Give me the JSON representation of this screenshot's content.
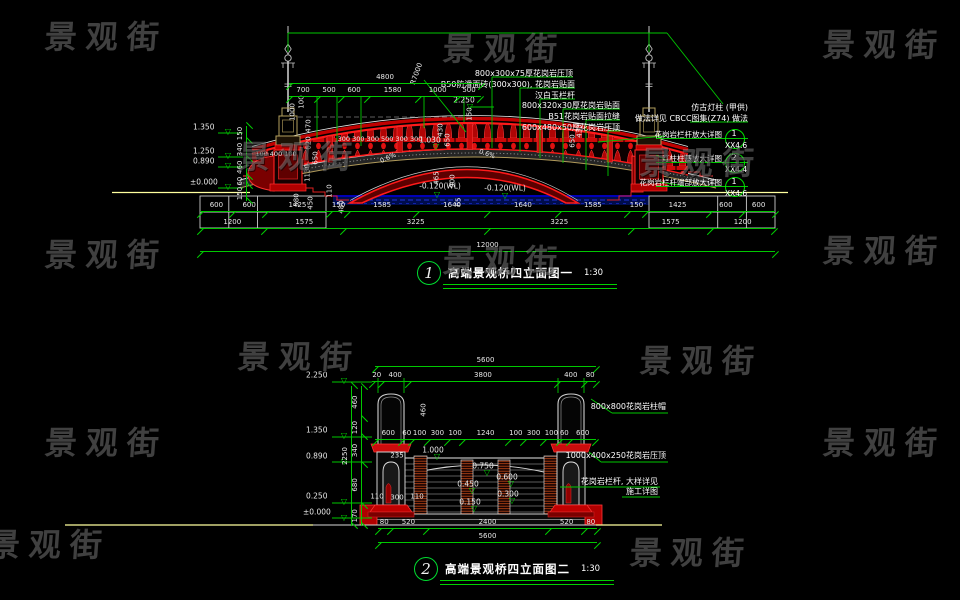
{
  "meta": {
    "background": "#000000",
    "dim_green": "#00c800",
    "structure_red": "#ff1a1a",
    "water_blue": "#000d4d",
    "ground_yellow": "#ffff9e",
    "stone_tan": "#b09a5a"
  },
  "watermark": {
    "text": "景观街",
    "positions": [
      [
        45,
        12
      ],
      [
        443,
        24
      ],
      [
        823,
        20
      ],
      [
        238,
        132
      ],
      [
        640,
        138
      ],
      [
        45,
        230
      ],
      [
        443,
        236
      ],
      [
        823,
        226
      ],
      [
        238,
        332
      ],
      [
        640,
        336
      ],
      [
        45,
        418
      ],
      [
        823,
        418
      ],
      [
        -12,
        520
      ],
      [
        630,
        528
      ]
    ]
  },
  "titles": [
    {
      "num": "1",
      "text": "高端景观桥四立面图一",
      "scale": "1:30",
      "x": 417,
      "y": 261
    },
    {
      "num": "2",
      "text": "高端景观桥四立面图二",
      "scale": "1:30",
      "x": 414,
      "y": 557
    }
  ],
  "bubbles": [
    {
      "num": "1",
      "code": "XX4.6",
      "note": "花岗岩栏杆放大详图",
      "x": 734,
      "y": 138
    },
    {
      "num": "2",
      "code": "XX4.4",
      "note": "灯柱柱基放大详图",
      "x": 734,
      "y": 162
    },
    {
      "num": "1",
      "code": "XX4.6",
      "note": "花岗岩栏杆端部放大详图",
      "x": 734,
      "y": 186
    }
  ],
  "chains": [
    {
      "x": 289,
      "y": 83,
      "w": 192,
      "segs": [
        "4800"
      ]
    },
    {
      "x": 289,
      "y": 96,
      "w": 192,
      "segs": [
        "700",
        "500",
        "600",
        "1580",
        "1000",
        "500"
      ]
    },
    {
      "x": 200,
      "y": 211,
      "w": 575,
      "segs": [
        "600",
        "600",
        "1425",
        "150",
        "1585",
        "1640",
        "1640",
        "1585",
        "150",
        "1425",
        "600",
        "600"
      ]
    },
    {
      "x": 200,
      "y": 228,
      "w": 575,
      "segs": [
        "1200",
        "1575",
        "3225",
        "3225",
        "1575",
        "1200"
      ]
    },
    {
      "x": 200,
      "y": 251,
      "w": 575,
      "segs": [
        "12000"
      ]
    },
    {
      "x": 247,
      "y": 125,
      "h": 75,
      "v": true,
      "segs": [
        "150",
        "340",
        "460",
        "60",
        "150"
      ]
    },
    {
      "x": 375,
      "y": 366,
      "w": 221,
      "segs": [
        "5600"
      ]
    },
    {
      "x": 372,
      "y": 381,
      "w": 224,
      "segs": [
        "20",
        "400",
        "3800",
        "400",
        "80"
      ]
    },
    {
      "x": 375,
      "y": 439,
      "w": 221,
      "segs": [
        "600",
        "60",
        "100",
        "300",
        "100",
        "1240",
        "100",
        "300",
        "100",
        "60",
        "600"
      ]
    },
    {
      "x": 378,
      "y": 528,
      "w": 219,
      "segs": [
        "80",
        "520",
        "2400",
        "520",
        "80"
      ]
    },
    {
      "x": 378,
      "y": 542,
      "w": 219,
      "segs": [
        "5600"
      ]
    },
    {
      "x": 362,
      "y": 385,
      "h": 140,
      "v": true,
      "segs": [
        "460",
        "120",
        "340",
        "680",
        "170"
      ]
    },
    {
      "x": 352,
      "y": 385,
      "h": 140,
      "v": true,
      "segs": [
        "2250"
      ]
    }
  ],
  "labels": [
    {
      "t": "R7000",
      "x": 417,
      "y": 74,
      "c": "d",
      "r": -70
    },
    {
      "t": "2.250",
      "x": 464,
      "y": 100,
      "c": "l"
    },
    {
      "t": "▽",
      "x": 470,
      "y": 107,
      "c": "g"
    },
    {
      "t": "150",
      "x": 470,
      "y": 114,
      "c": "d",
      "r": -90
    },
    {
      "t": "1.350",
      "x": 193,
      "y": 127,
      "c": "l",
      "a": "l"
    },
    {
      "t": "▽",
      "x": 228,
      "y": 132,
      "c": "g"
    },
    {
      "t": "1.250",
      "x": 193,
      "y": 151,
      "c": "l",
      "a": "l"
    },
    {
      "t": "▽",
      "x": 228,
      "y": 156,
      "c": "g"
    },
    {
      "t": "0.890",
      "x": 193,
      "y": 161,
      "c": "l",
      "a": "l"
    },
    {
      "t": "▽",
      "x": 228,
      "y": 166,
      "c": "g"
    },
    {
      "t": "±0.000",
      "x": 190,
      "y": 182,
      "c": "l",
      "a": "l"
    },
    {
      "t": "▽",
      "x": 228,
      "y": 187,
      "c": "g"
    },
    {
      "t": "1000",
      "x": 293,
      "y": 112,
      "c": "d",
      "r": -90
    },
    {
      "t": "100",
      "x": 302,
      "y": 102,
      "c": "d",
      "r": -90
    },
    {
      "t": "470",
      "x": 309,
      "y": 126,
      "c": "d",
      "r": -90
    },
    {
      "t": "620",
      "x": 309,
      "y": 143,
      "c": "d",
      "r": -90
    },
    {
      "t": "650",
      "x": 316,
      "y": 158,
      "c": "d",
      "r": -90
    },
    {
      "t": "1130",
      "x": 308,
      "y": 173,
      "c": "d",
      "r": -90
    },
    {
      "t": "100 400 100",
      "x": 276,
      "y": 154,
      "c": "s"
    },
    {
      "t": "580",
      "x": 297,
      "y": 200,
      "c": "d",
      "r": -90
    },
    {
      "t": "450",
      "x": 311,
      "y": 203,
      "c": "d",
      "r": -90
    },
    {
      "t": "110",
      "x": 330,
      "y": 191,
      "c": "d",
      "r": -90
    },
    {
      "t": "480",
      "x": 342,
      "y": 207,
      "c": "d",
      "r": -90
    },
    {
      "t": "300 300 300 500 300 300",
      "x": 380,
      "y": 139,
      "c": "s"
    },
    {
      "t": "0.6%",
      "x": 388,
      "y": 158,
      "c": "s",
      "r": -25
    },
    {
      "t": "1.030",
      "x": 430,
      "y": 140,
      "c": "l"
    },
    {
      "t": "▽",
      "x": 436,
      "y": 147,
      "c": "g"
    },
    {
      "t": "0.6%",
      "x": 487,
      "y": 154,
      "c": "s",
      "r": 20
    },
    {
      "t": "430",
      "x": 441,
      "y": 130,
      "c": "d",
      "r": -90
    },
    {
      "t": "650",
      "x": 448,
      "y": 140,
      "c": "d",
      "r": -90
    },
    {
      "t": "465",
      "x": 437,
      "y": 178,
      "c": "d",
      "r": -90
    },
    {
      "t": "900",
      "x": 453,
      "y": 181,
      "c": "d",
      "r": -90
    },
    {
      "t": "65",
      "x": 459,
      "y": 202,
      "c": "d",
      "r": -90
    },
    {
      "t": "430",
      "x": 580,
      "y": 131,
      "c": "d",
      "r": -90
    },
    {
      "t": "650",
      "x": 573,
      "y": 141,
      "c": "d",
      "r": -90
    },
    {
      "t": "-0.120(WL)",
      "x": 440,
      "y": 186,
      "c": "l"
    },
    {
      "t": "▽",
      "x": 437,
      "y": 195,
      "c": "g"
    },
    {
      "t": "-0.120(WL)",
      "x": 505,
      "y": 188,
      "c": "l"
    },
    {
      "t": "▽",
      "x": 505,
      "y": 196,
      "c": "g"
    },
    {
      "t": "800x300x75厚花岗岩压顶",
      "x": 573,
      "y": 74,
      "c": "a",
      "a": "r"
    },
    {
      "t": "B50防滑面砖(300x300), 花岗岩贴面",
      "x": 575,
      "y": 85,
      "c": "a",
      "a": "r"
    },
    {
      "t": "汉白玉栏杆",
      "x": 575,
      "y": 96,
      "c": "a",
      "a": "r"
    },
    {
      "t": "800x320x30厚花岗岩贴面",
      "x": 620,
      "y": 106,
      "c": "a",
      "a": "r"
    },
    {
      "t": "B51花岗岩贴面拉缝",
      "x": 620,
      "y": 117,
      "c": "a",
      "a": "r"
    },
    {
      "t": "600x480x50厚花岗岩压顶",
      "x": 620,
      "y": 128,
      "c": "a",
      "a": "r"
    },
    {
      "t": "仿古灯柱 (甲供)",
      "x": 748,
      "y": 108,
      "c": "a",
      "a": "r"
    },
    {
      "t": "做法详见 CBCC图集(Z74) 做法",
      "x": 748,
      "y": 119,
      "c": "a",
      "a": "r"
    },
    {
      "t": "2.250",
      "x": 306,
      "y": 375,
      "c": "l",
      "a": "l"
    },
    {
      "t": "▽",
      "x": 344,
      "y": 381,
      "c": "g"
    },
    {
      "t": "1.350",
      "x": 306,
      "y": 430,
      "c": "l",
      "a": "l"
    },
    {
      "t": "▽",
      "x": 344,
      "y": 436,
      "c": "g"
    },
    {
      "t": "0.890",
      "x": 306,
      "y": 456,
      "c": "l",
      "a": "l"
    },
    {
      "t": "▽",
      "x": 344,
      "y": 462,
      "c": "g"
    },
    {
      "t": "0.250",
      "x": 306,
      "y": 496,
      "c": "l",
      "a": "l"
    },
    {
      "t": "▽",
      "x": 344,
      "y": 502,
      "c": "g"
    },
    {
      "t": "±0.000",
      "x": 303,
      "y": 512,
      "c": "l",
      "a": "l"
    },
    {
      "t": "▽",
      "x": 344,
      "y": 518,
      "c": "g"
    },
    {
      "t": "460",
      "x": 424,
      "y": 410,
      "c": "d",
      "r": -90
    },
    {
      "t": "235",
      "x": 397,
      "y": 456,
      "c": "d"
    },
    {
      "t": "1.000",
      "x": 433,
      "y": 450,
      "c": "l"
    },
    {
      "t": "▽",
      "x": 437,
      "y": 457,
      "c": "g"
    },
    {
      "t": "0.750",
      "x": 483,
      "y": 466,
      "c": "l"
    },
    {
      "t": "▽",
      "x": 487,
      "y": 473,
      "c": "g"
    },
    {
      "t": "0.600",
      "x": 507,
      "y": 477,
      "c": "l"
    },
    {
      "t": "▽",
      "x": 511,
      "y": 484,
      "c": "g"
    },
    {
      "t": "0.450",
      "x": 468,
      "y": 484,
      "c": "l"
    },
    {
      "t": "▽",
      "x": 472,
      "y": 491,
      "c": "g"
    },
    {
      "t": "0.300",
      "x": 508,
      "y": 494,
      "c": "l"
    },
    {
      "t": "▽",
      "x": 512,
      "y": 501,
      "c": "g"
    },
    {
      "t": "0.150",
      "x": 470,
      "y": 502,
      "c": "l"
    },
    {
      "t": "▽",
      "x": 474,
      "y": 509,
      "c": "g"
    },
    {
      "t": "110",
      "x": 377,
      "y": 497,
      "c": "d"
    },
    {
      "t": "300",
      "x": 397,
      "y": 498,
      "c": "d"
    },
    {
      "t": "110",
      "x": 417,
      "y": 497,
      "c": "d"
    },
    {
      "t": "800x800花岗岩柱帽",
      "x": 666,
      "y": 407,
      "c": "a",
      "a": "r"
    },
    {
      "t": "1000x400x250花岗岩压顶",
      "x": 666,
      "y": 456,
      "c": "a",
      "a": "r"
    },
    {
      "t": "花岗岩栏杆, 大样详见",
      "x": 658,
      "y": 482,
      "c": "a",
      "a": "r"
    },
    {
      "t": "施工详图",
      "x": 658,
      "y": 492,
      "c": "a",
      "a": "r"
    }
  ]
}
